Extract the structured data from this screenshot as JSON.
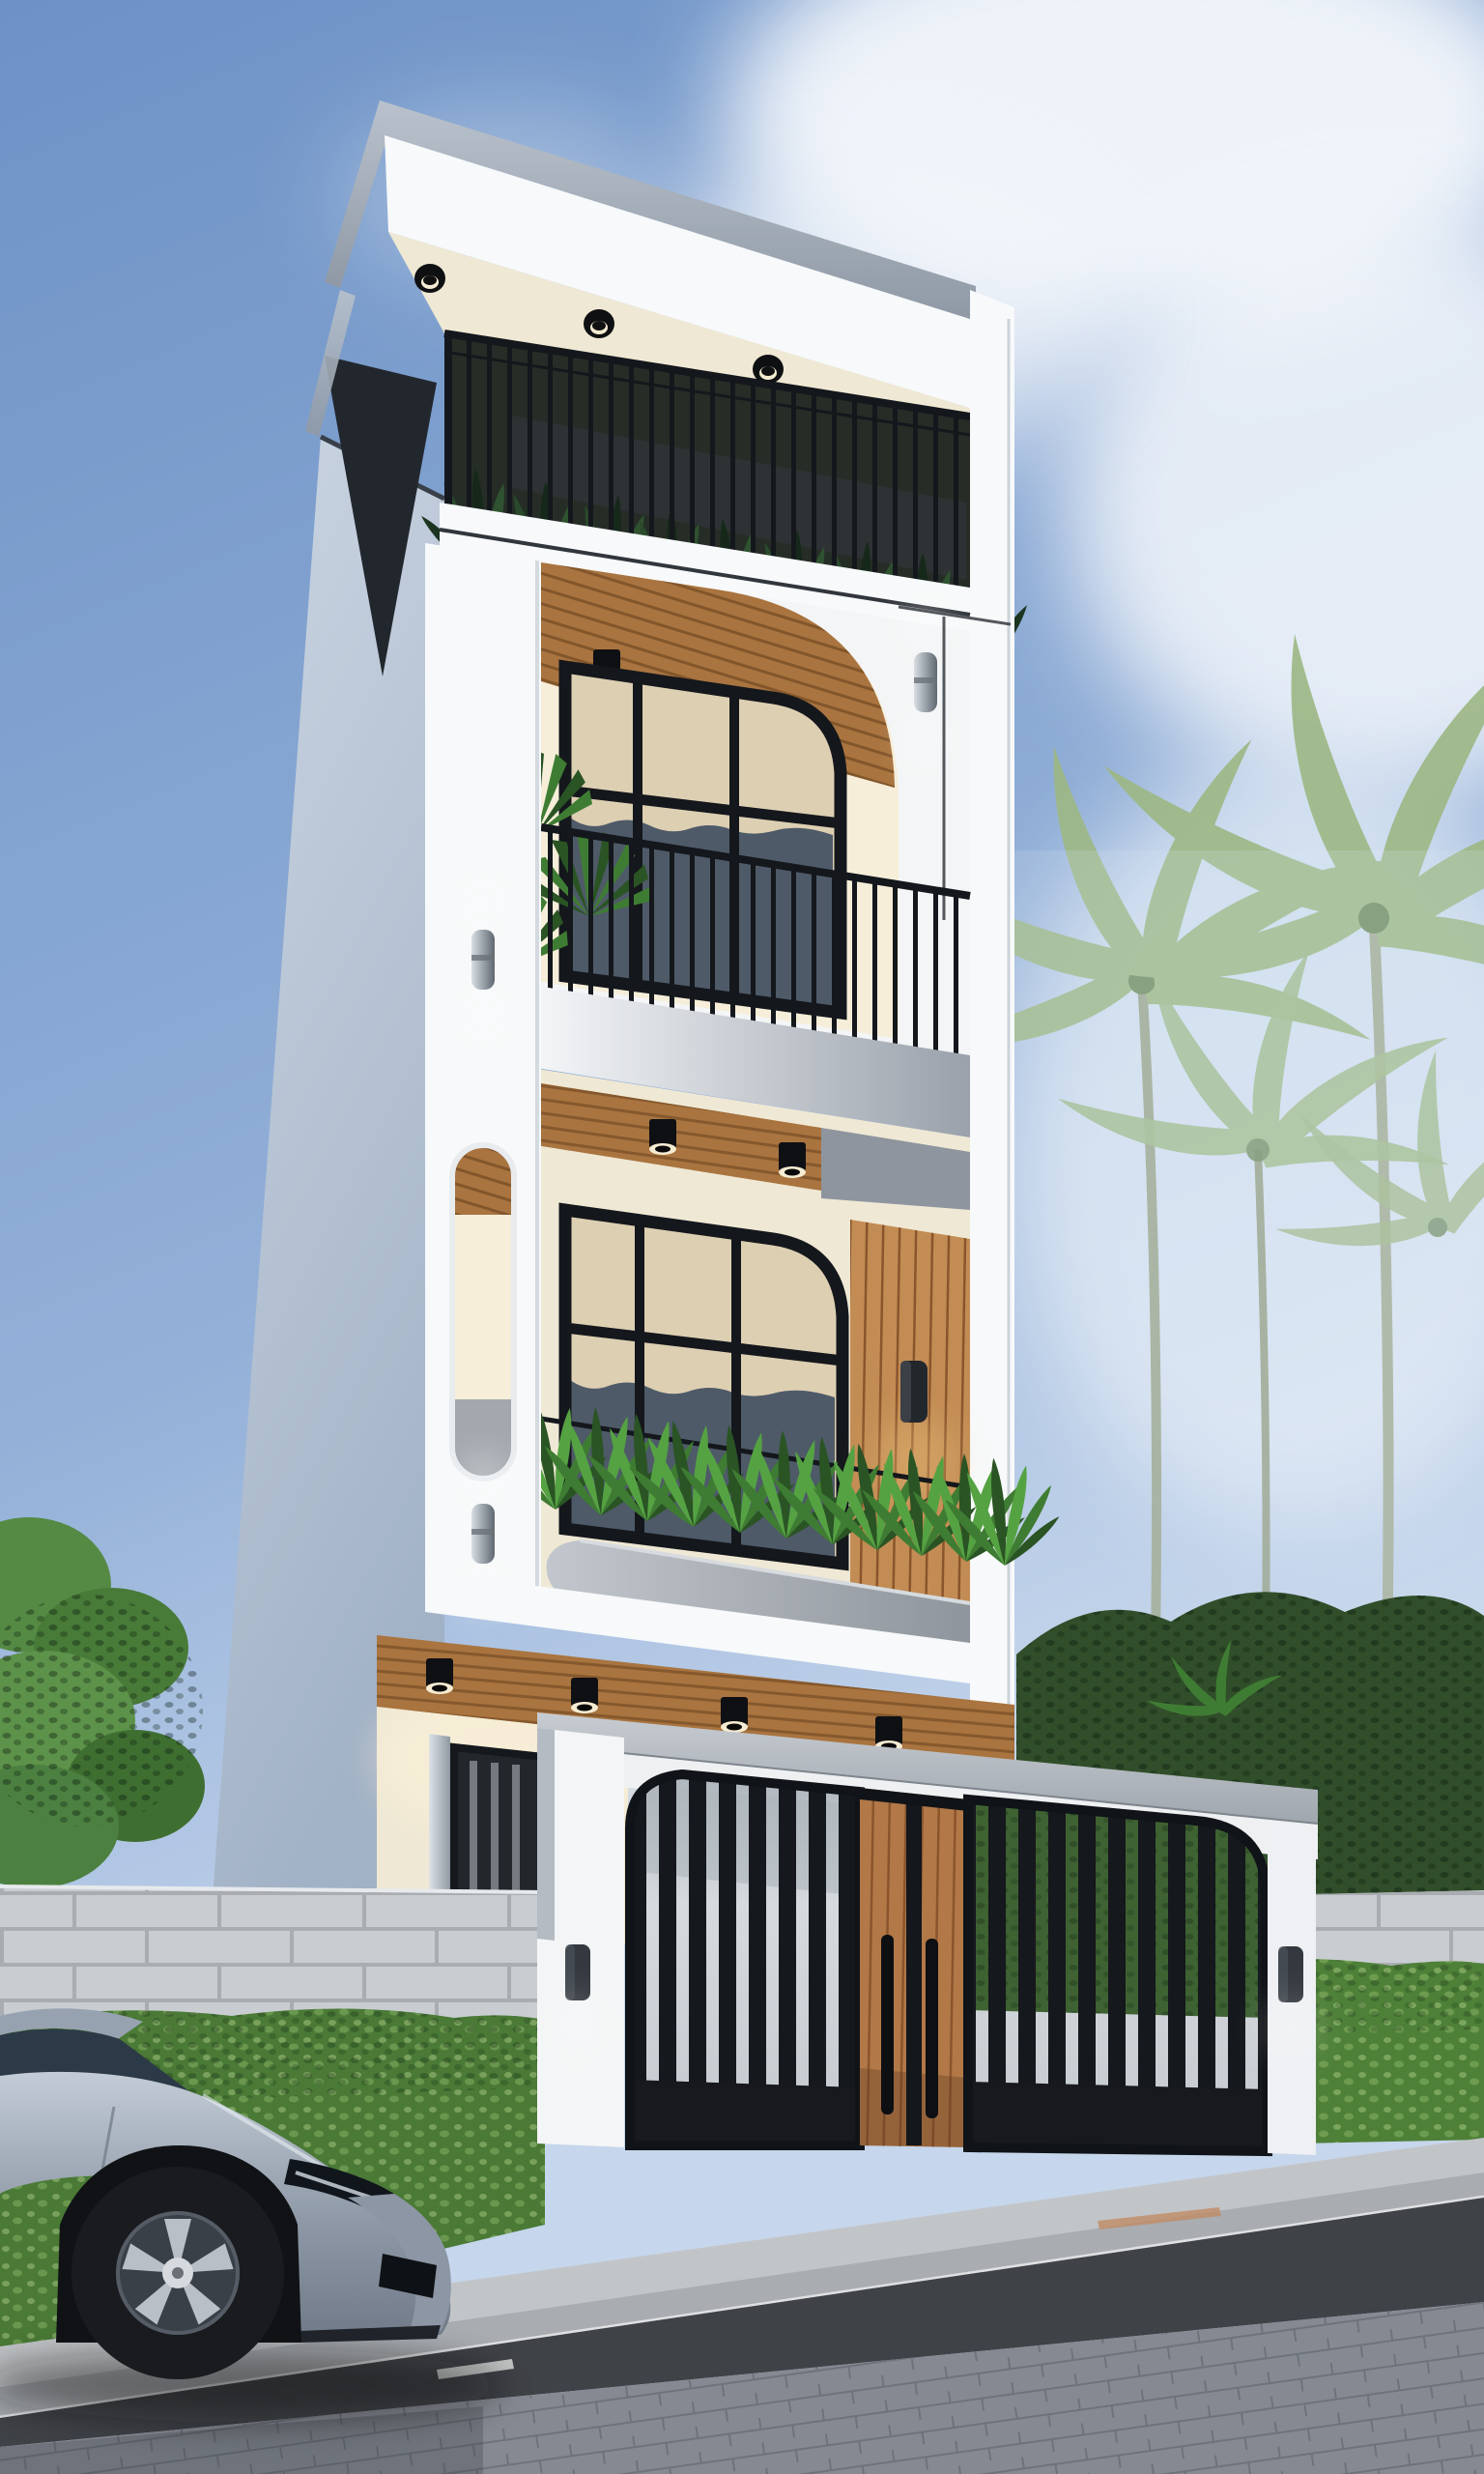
{
  "meta": {
    "title": "Modern narrow townhouse exterior - photorealistic 3D architectural render",
    "view": "street-level looking up, day time, clear sky"
  },
  "palette": {
    "sky1": "#6d92c6",
    "sky2": "#93b0d8",
    "sky3": "#c6d6ec",
    "cloud": "#f5f8fc",
    "white": "#f7f9fa",
    "whiteShade": "#e3e8ee",
    "side1": "#ccd6e3",
    "side2": "#a2b2c6",
    "roofG1": "#b9c2cc",
    "roofG2": "#8f99a5",
    "cream": "#efe8d4",
    "creamLit": "#f6eed9",
    "wood1": "#a9743f",
    "wood2": "#7c5128",
    "wood3": "#c28c54",
    "doorW": "#b27848",
    "doorWd": "#8a552c",
    "metal": "#14171c",
    "dark": "#101317",
    "glassD": "#4e5a68",
    "glassDD": "#2b3036",
    "curtain": "#ddcfb2",
    "curtainSh": "#b09f7f",
    "plant1": "#55a243",
    "plant2": "#3f7c33",
    "plant3": "#2a5424",
    "foliage": "#1d3320",
    "bushes": "#314e2a",
    "hedge1": "#4a7a36",
    "hedge2": "#36612a",
    "palm": "#9db885",
    "stone": "#c9cdd1",
    "stoneL": "#a9adb2",
    "coping1": "#c7ccd2",
    "coping2": "#9fa6ad",
    "curbT": "#c2c5c8",
    "curbF": "#a9adb1",
    "road": "#3f4247",
    "paver": "#858a92",
    "paverL": "#6e737b",
    "slatGap": "#c8cdd3",
    "carA": "#c3ccd6",
    "carB": "#8e99a7",
    "carC": "#6f7987",
    "carGlass": "#2c3a47",
    "tire": "#191b1f",
    "rim": "#a7aeb8",
    "glow": "#f6ecd2"
  },
  "scene": {
    "sky": {
      "clouds": 4
    },
    "building": {
      "floors": 4,
      "style": "modern minimalist white facade, rounded arches, black steel railings, wood slat accents",
      "rooftop": {
        "railing": "black vertical bars",
        "plants": true,
        "soffit_downlights": 3
      },
      "third_floor": {
        "arched_opening": true,
        "wood_slat_ceiling": true,
        "ceiling_downlights": 2,
        "arched_window": true,
        "balcony_railing": "black vertical bars",
        "fan_palm_plant": true,
        "wall_sconce": 1
      },
      "second_floor": {
        "arched_window": true,
        "curtains": true,
        "wood_slat_wall_panel": true,
        "panel_sconce": 1,
        "planter_box_plants": true,
        "balcony_soffit_downlights": 2,
        "pier_capsule_niche": 1,
        "pier_sconces": 2
      },
      "ground_floor": {
        "porch_soffit_downlights": 4,
        "glazed_entry_door": true,
        "pillar_sconces": 2,
        "gate": {
          "left_slat_panel": true,
          "wood_double_door": true,
          "door_handles": 2,
          "right_slat_panel": true,
          "rounded_top_corners": true
        },
        "fence_coping": "grey"
      }
    },
    "surroundings": {
      "left_tree": true,
      "stone_block_wall": true,
      "hedges": 2,
      "palm_trees": 4,
      "dark_shrubs": true
    },
    "street": {
      "curb": true,
      "asphalt_road": true,
      "paver_sidewalk": true,
      "road_dash_marks": 2
    },
    "vehicle": {
      "type": "silver sedan, parked, nose to the right",
      "wheel_spokes": 5
    }
  }
}
